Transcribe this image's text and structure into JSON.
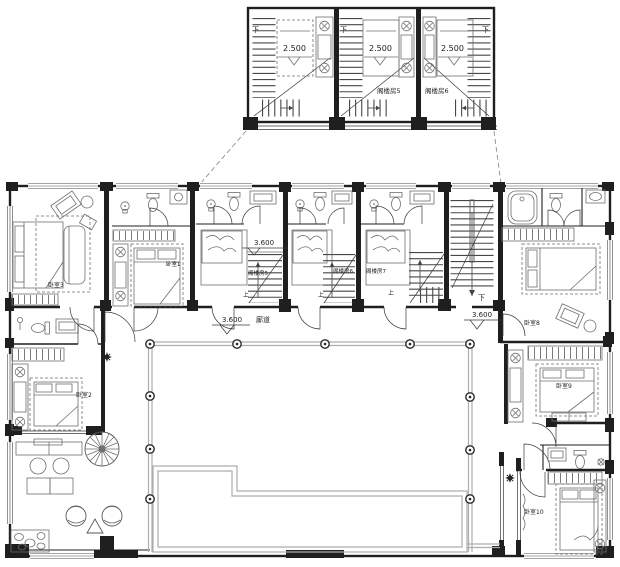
{
  "drawing": {
    "kind": "residential floor plan with attic detail callout",
    "detail_box": {
      "rooms": [
        {
          "stair_mark": "下",
          "bed_dim": "2.500",
          "name": ""
        },
        {
          "stair_mark": "下",
          "bed_dim": "2.500",
          "name": "阁楼房5"
        },
        {
          "stair_mark": "下",
          "bed_dim": "2.500",
          "name": "阁楼房6"
        }
      ]
    },
    "plan": {
      "bedrooms": {
        "b1": "卧室1",
        "b2": "卧室2",
        "b3": "卧室3",
        "b8": "卧室8",
        "b9": "卧室9",
        "b10": "卧室10"
      },
      "attics": {
        "a5": "阁楼房5",
        "a6": "阁楼房6",
        "a7": "阁楼房7"
      },
      "dims": {
        "attic_bay": "3.600",
        "corridor_left": "3.600",
        "corridor_right": "3.600"
      },
      "texts": {
        "corridor_name": "廊道",
        "stair_up": "上",
        "stair_down": "下"
      }
    },
    "colors": {
      "wall": "#1f1f1f",
      "furniture": "#6f6f6f",
      "light_lines": "#adadad",
      "background": "#ffffff"
    }
  }
}
